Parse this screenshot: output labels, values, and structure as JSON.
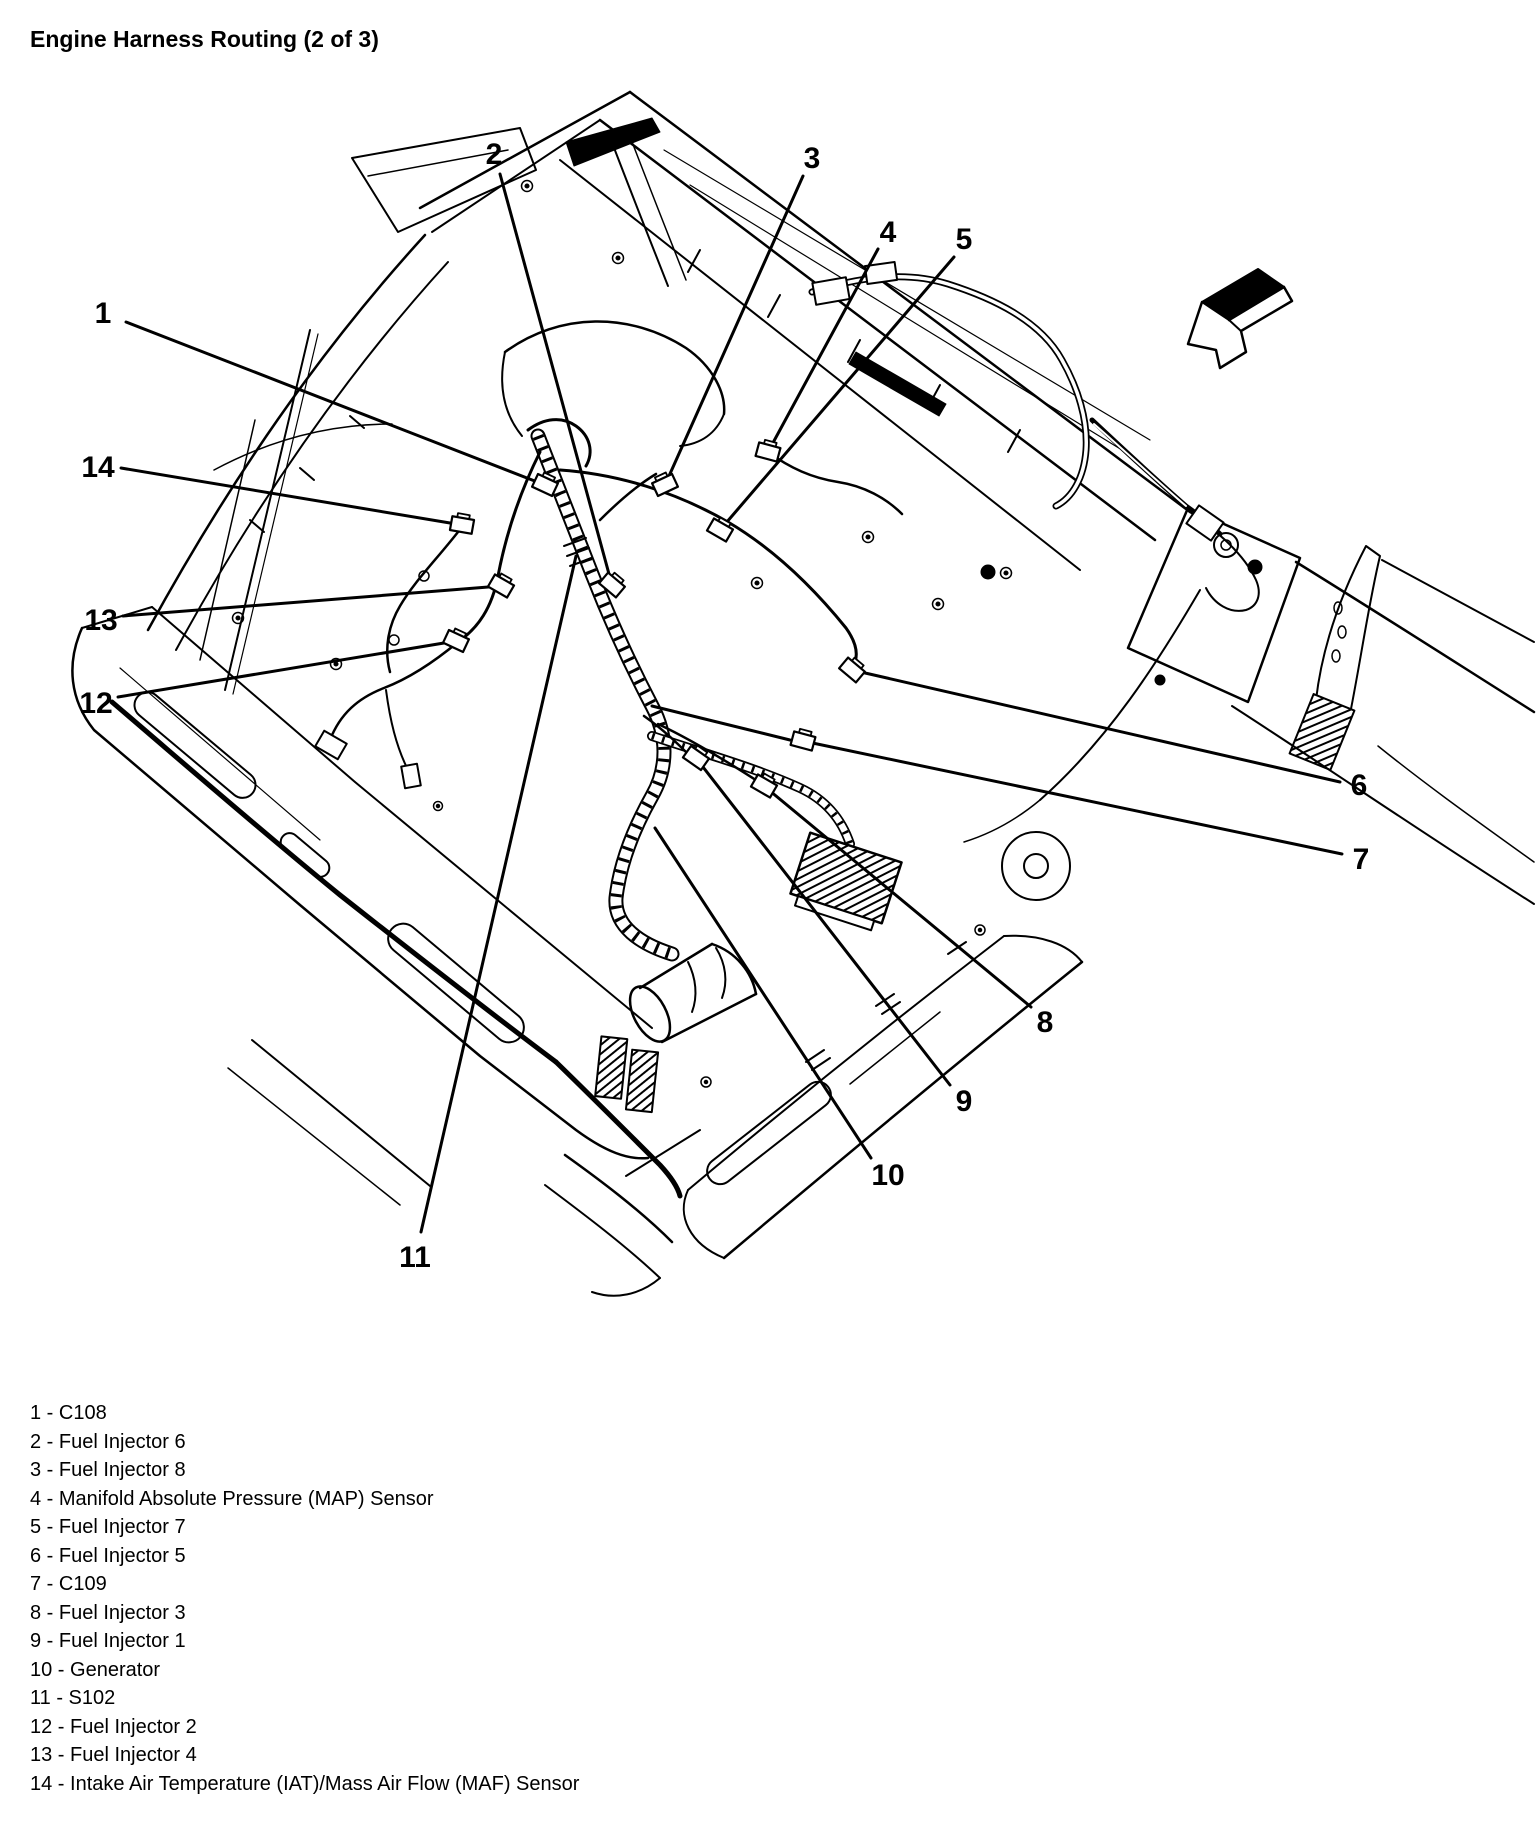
{
  "title": "Engine Harness Routing (2 of 3)",
  "colors": {
    "ink": "#000000",
    "paper": "#ffffff"
  },
  "icons": {
    "direction_arrow": "3d-arrow-down-left"
  },
  "diagram": {
    "type": "callout-diagram",
    "description": "Engine compartment line art (view into engine bay from front) with numbered wiring-harness callouts",
    "legend_separator": " - ",
    "callouts": [
      {
        "num": "1",
        "label": "C108",
        "lx": 103,
        "ly": 312,
        "sx": 126,
        "sy": 322,
        "ex": 545,
        "ey": 485,
        "connector": true,
        "rot": 25
      },
      {
        "num": "2",
        "label": "Fuel Injector 6",
        "lx": 494,
        "ly": 153,
        "sx": 500,
        "sy": 174,
        "ex": 612,
        "ey": 585,
        "connector": true,
        "rot": 40
      },
      {
        "num": "3",
        "label": "Fuel Injector 8",
        "lx": 812,
        "ly": 157,
        "sx": 803,
        "sy": 176,
        "ex": 665,
        "ey": 485,
        "connector": true,
        "rot": -25
      },
      {
        "num": "4",
        "label": "Manifold Absolute Pressure (MAP) Sensor",
        "lx": 888,
        "ly": 231,
        "sx": 878,
        "sy": 249,
        "ex": 768,
        "ey": 452,
        "connector": true,
        "rot": 15
      },
      {
        "num": "5",
        "label": "Fuel Injector 7",
        "lx": 964,
        "ly": 238,
        "sx": 954,
        "sy": 257,
        "ex": 720,
        "ey": 530,
        "connector": true,
        "rot": 30
      },
      {
        "num": "6",
        "label": "Fuel Injector 5",
        "lx": 1359,
        "ly": 784,
        "sx": 1340,
        "sy": 782,
        "ex": 852,
        "ey": 670,
        "connector": true,
        "rot": 40
      },
      {
        "num": "7",
        "label": "C109",
        "lx": 1361,
        "ly": 858,
        "sx": 1342,
        "sy": 854,
        "ex": 803,
        "ey": 741,
        "connector": true,
        "rot": 15
      },
      {
        "num": "8",
        "label": "Fuel Injector 3",
        "lx": 1045,
        "ly": 1021,
        "sx": 1031,
        "sy": 1007,
        "ex": 764,
        "ey": 786,
        "connector": true,
        "rot": 30
      },
      {
        "num": "9",
        "label": "Fuel Injector 1",
        "lx": 964,
        "ly": 1100,
        "sx": 950,
        "sy": 1085,
        "ex": 696,
        "ey": 758,
        "connector": true,
        "rot": 35
      },
      {
        "num": "10",
        "label": "Generator",
        "lx": 888,
        "ly": 1174,
        "sx": 871,
        "sy": 1158,
        "ex": 655,
        "ey": 828,
        "connector": false,
        "rot": 0
      },
      {
        "num": "11",
        "label": "S102",
        "lx": 415,
        "ly": 1256,
        "sx": 421,
        "sy": 1232,
        "ex": 576,
        "ey": 556,
        "connector": false,
        "rot": 0
      },
      {
        "num": "12",
        "label": "Fuel Injector 2",
        "lx": 96,
        "ly": 702,
        "sx": 118,
        "sy": 697,
        "ex": 456,
        "ey": 641,
        "connector": true,
        "rot": 25
      },
      {
        "num": "13",
        "label": "Fuel Injector 4",
        "lx": 101,
        "ly": 619,
        "sx": 123,
        "sy": 616,
        "ex": 501,
        "ey": 586,
        "connector": true,
        "rot": 30
      },
      {
        "num": "14",
        "label": "Intake Air Temperature (IAT)/Mass Air Flow (MAF) Sensor",
        "lx": 98,
        "ly": 466,
        "sx": 121,
        "sy": 468,
        "ex": 462,
        "ey": 525,
        "connector": true,
        "rot": 10
      }
    ]
  }
}
